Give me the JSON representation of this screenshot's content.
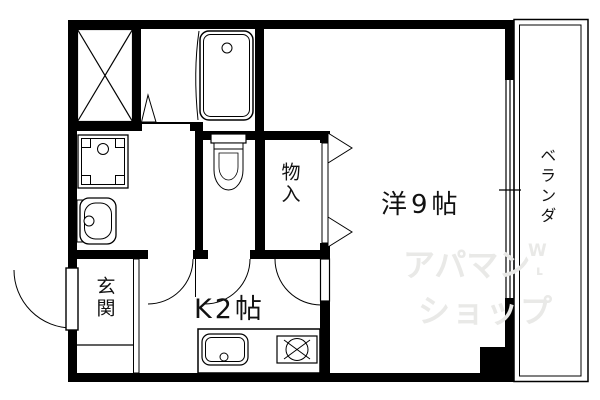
{
  "rooms": {
    "entrance": {
      "label": "玄関"
    },
    "kitchen": {
      "label": "K2帖"
    },
    "main_room": {
      "label": "洋9帖"
    },
    "storage": {
      "label": "物入"
    },
    "veranda": {
      "label": "ベランダ"
    }
  },
  "watermark": {
    "line1": "アパマン",
    "line2": "ショップ",
    "mark": "W",
    "mark2": "ʟ",
    "color": "#e9e9e7"
  },
  "colors": {
    "walls": "#000000",
    "lines": "#000000",
    "background": "#ffffff"
  },
  "fixtures": [
    "closet-cross",
    "bathtub",
    "washing-machine-pan",
    "wash-basin",
    "toilet",
    "storage-doors",
    "entrance-door",
    "kitchen-sink",
    "gas-stove",
    "sliding-window",
    "door-arcs"
  ]
}
